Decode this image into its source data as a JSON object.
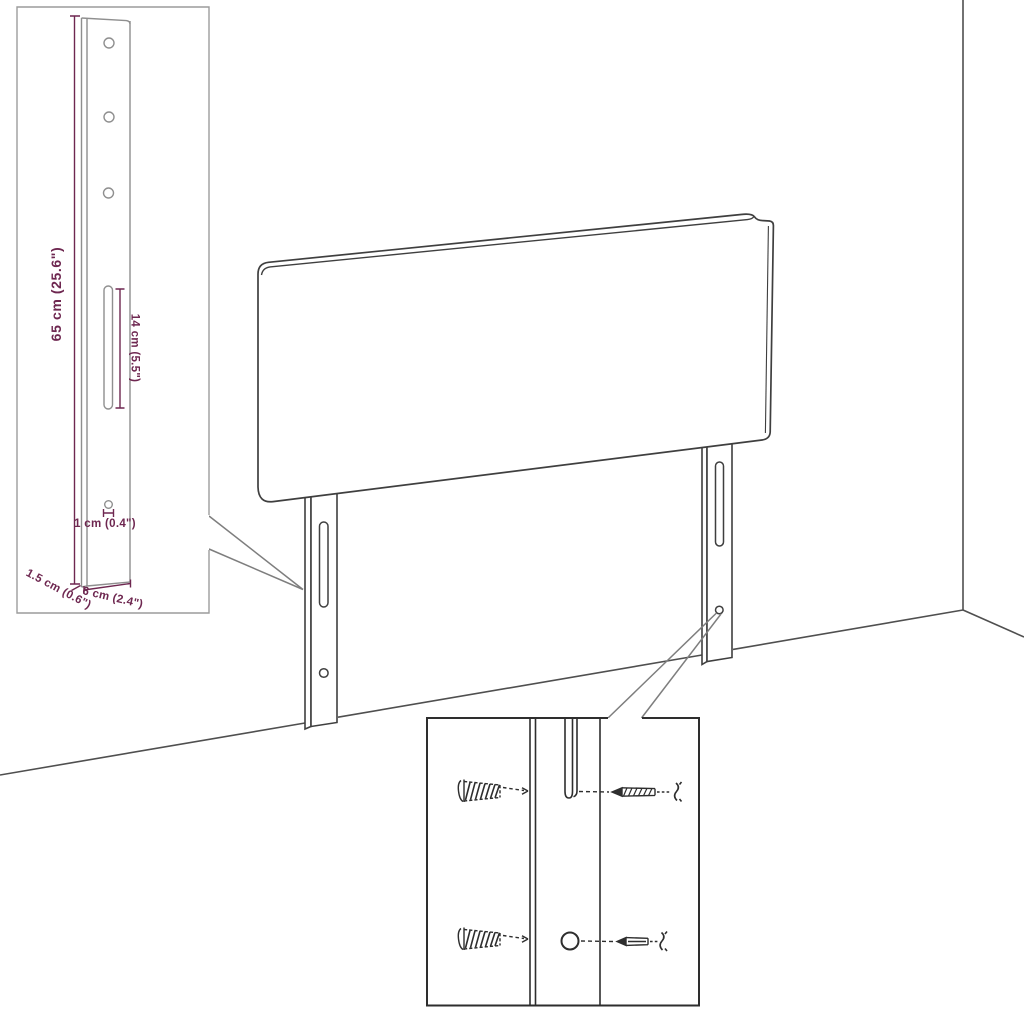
{
  "colors": {
    "background": "#ffffff",
    "dimension_purple": "#6e2750",
    "sketch_gray": "#8f8f8f",
    "outline_dark": "#3f3f3f",
    "room_line": "#4f4f4f",
    "callout_gray": "#7e7e7e",
    "inset_border_light": "#9c9c9c",
    "detail_dark": "#2e2e2e"
  },
  "bracket_inset": {
    "labels": {
      "height": "65 cm (25.6\")",
      "slot_length": "14 cm (5.5\")",
      "hole_diameter": "1 cm (0.4\")",
      "width": "6 cm (2.4\")",
      "depth": "1.5 cm (0.6\")"
    }
  }
}
